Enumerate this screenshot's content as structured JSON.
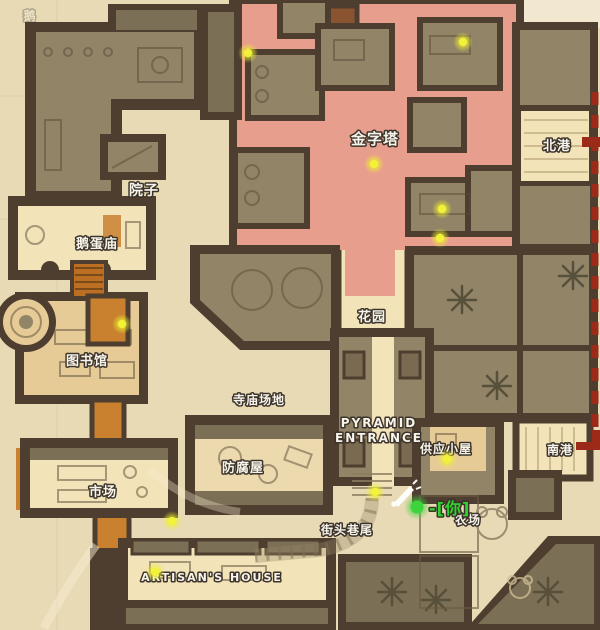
{
  "map_title": "pyramid-town-game-map",
  "colors": {
    "parchment": "#e8dab5",
    "parchment_light": "#f1e8cf",
    "wall": "#4e3e2f",
    "wall_light": "#7b6a52",
    "room_olive": "#918467",
    "room_olive_dark": "#7b6f55",
    "pink": "#e79e8d",
    "cream": "#f2e3b8",
    "tan": "#e7cb97",
    "tan_light": "#ecd9ad",
    "orange": "#c9802f",
    "orange_dark": "#bc6e22",
    "loot_core": "#f2f239",
    "loot_glow": "#eef02e",
    "player_core": "#3ed43e",
    "player_glow": "#3cd23c",
    "extraction": "#9c2a19",
    "label_fill": "#f7f4ec",
    "label_stroke": "#3c332a",
    "player_label": "#2fd32f",
    "sketch": "#5a4c38"
  },
  "labels": [
    {
      "id": "ghost-corner",
      "text": "鹅",
      "x": 30,
      "y": 20,
      "size": 12,
      "opacity": 0.3
    },
    {
      "id": "pyramid",
      "text": "金字塔",
      "x": 375,
      "y": 144,
      "size": 15
    },
    {
      "id": "north-port",
      "text": "北港",
      "x": 557,
      "y": 150,
      "size": 13
    },
    {
      "id": "courtyard",
      "text": "院子",
      "x": 144,
      "y": 195,
      "size": 14
    },
    {
      "id": "egg-temple",
      "text": "鹅蛋庙",
      "x": 97,
      "y": 248,
      "size": 13
    },
    {
      "id": "garden",
      "text": "花园",
      "x": 372,
      "y": 321,
      "size": 13
    },
    {
      "id": "library",
      "text": "图书馆",
      "x": 87,
      "y": 365,
      "size": 13
    },
    {
      "id": "temple-grounds",
      "text": "寺庙场地",
      "x": 259,
      "y": 404,
      "size": 12
    },
    {
      "id": "pyramid-entrance",
      "lines": [
        "PYRAMID",
        "ENTRANCE"
      ],
      "x": 379,
      "y": 427,
      "size": 12,
      "latin": true
    },
    {
      "id": "supply-hut",
      "text": "供应小屋",
      "x": 446,
      "y": 453,
      "size": 12
    },
    {
      "id": "south-port",
      "text": "南港",
      "x": 560,
      "y": 454,
      "size": 12
    },
    {
      "id": "embalming-house",
      "text": "防腐屋",
      "x": 243,
      "y": 472,
      "size": 13
    },
    {
      "id": "market",
      "text": "市场",
      "x": 103,
      "y": 496,
      "size": 13
    },
    {
      "id": "street-corner",
      "text": "街头巷尾",
      "x": 347,
      "y": 534,
      "size": 12
    },
    {
      "id": "farm",
      "text": "农场",
      "x": 468,
      "y": 524,
      "size": 12
    },
    {
      "id": "artisans-house",
      "text": "ARTISAN'S HOUSE",
      "x": 212,
      "y": 581,
      "size": 11,
      "latin": true
    }
  ],
  "player_marker": {
    "text": "-[你]",
    "text_x": 429,
    "text_y": 514,
    "dot_x": 417,
    "dot_y": 507,
    "size": 16
  },
  "icons": {
    "announcement": "megaphone-icon"
  },
  "loot_dots": [
    {
      "x": 248,
      "y": 53
    },
    {
      "x": 463,
      "y": 42
    },
    {
      "x": 374,
      "y": 164
    },
    {
      "x": 442,
      "y": 209
    },
    {
      "x": 440,
      "y": 238
    },
    {
      "x": 122,
      "y": 324
    },
    {
      "x": 447,
      "y": 459
    },
    {
      "x": 375,
      "y": 492
    },
    {
      "x": 172,
      "y": 521
    },
    {
      "x": 155,
      "y": 572
    }
  ],
  "extraction_line": {
    "x": 595,
    "y_top": 92,
    "y_bottom": 434,
    "bracket_north_y": 142,
    "bracket_south_y": 438
  }
}
